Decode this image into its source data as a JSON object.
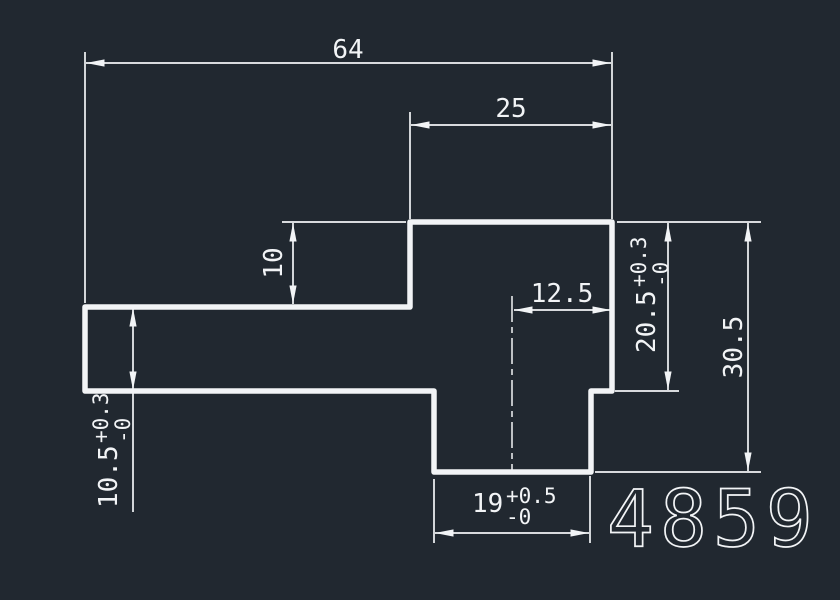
{
  "drawing": {
    "part_number": "4859",
    "colors": {
      "background": "#212830",
      "line": "#f2f4f6"
    },
    "dimensions": {
      "total_width": {
        "value": "64"
      },
      "top_block_width": {
        "value": "25"
      },
      "step_height": {
        "value": "10"
      },
      "center_to_right_edge": {
        "value": "12.5"
      },
      "right_block_height": {
        "value": "20.5",
        "tol_plus": "+0.3",
        "tol_minus": "-0"
      },
      "right_total_height": {
        "value": "30.5"
      },
      "left_bar_height": {
        "value": "10.5",
        "tol_plus": "+0.3",
        "tol_minus": "-0"
      },
      "bottom_block_width": {
        "value": "19",
        "tol_plus": "+0.5",
        "tol_minus": "-0"
      }
    }
  }
}
